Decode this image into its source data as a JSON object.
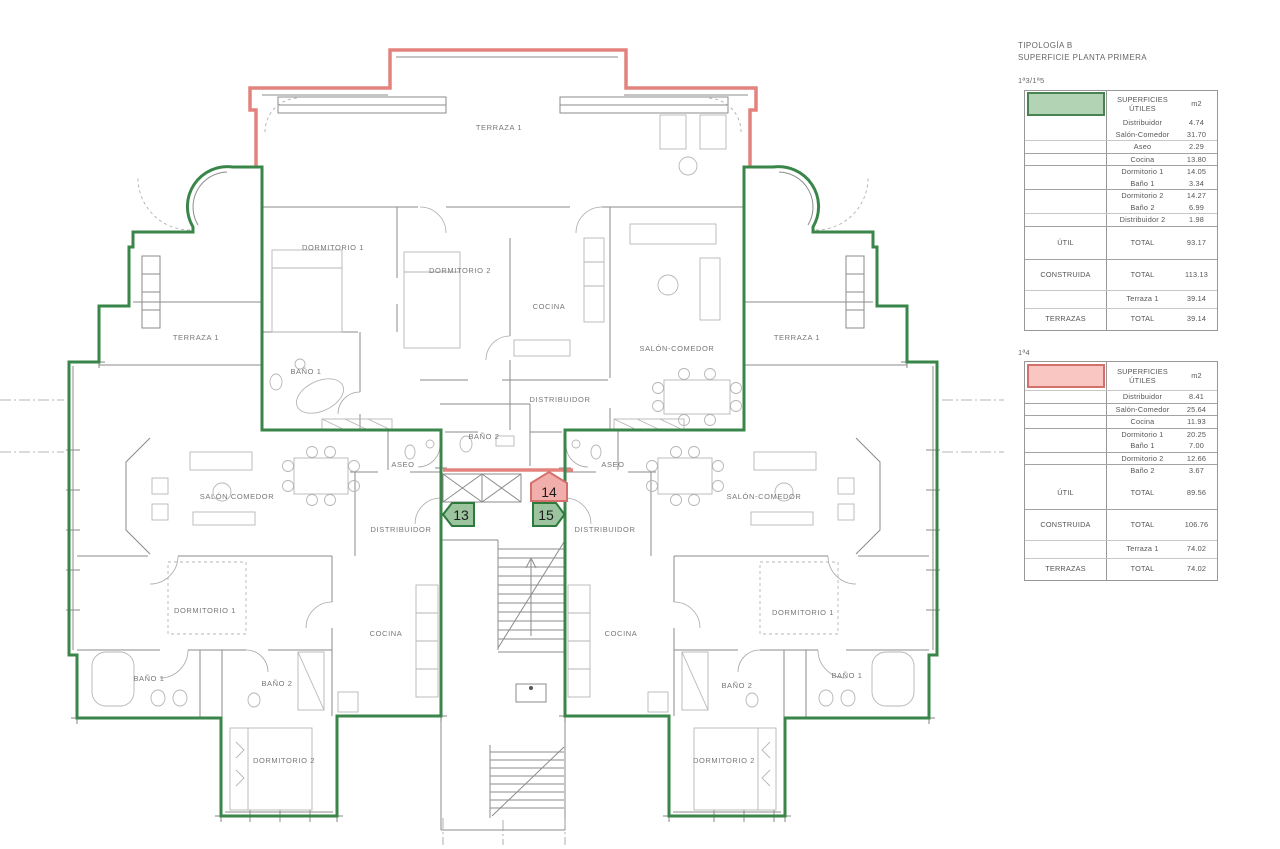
{
  "legend": {
    "title_line1": "TIPOLOGÍA B",
    "title_line2": "SUPERFICIE PLANTA PRIMERA",
    "tables": [
      {
        "unit_ref": "1ª3/1ª5",
        "swatch_color": "#b2d3b4",
        "swatch_border": "#47824f",
        "col_header_line1": "SUPERFICIES",
        "col_header_line2": "ÚTILES",
        "unit_header": "m2",
        "items": [
          {
            "name": "Distribuidor",
            "value": "4.74"
          },
          {
            "name": "Salón-Comedor",
            "value": "31.70"
          },
          {
            "name": "Aseo",
            "value": "2.29"
          },
          {
            "name": "Cocina",
            "value": "13.80"
          },
          {
            "name": "Dormitorio 1",
            "value": "14.05"
          },
          {
            "name": "Baño 1",
            "value": "3.34"
          },
          {
            "name": "Dormitorio 2",
            "value": "14.27"
          },
          {
            "name": "Baño 2",
            "value": "6.99"
          },
          {
            "name": "Distribuidor 2",
            "value": "1.98"
          }
        ],
        "totals": [
          {
            "section": "ÚTIL",
            "name": "TOTAL",
            "value": "93.17"
          },
          {
            "section": "CONSTRUIDA",
            "name": "TOTAL",
            "value": "113.13"
          },
          {
            "section": "",
            "name": "Terraza 1",
            "value": "39.14"
          },
          {
            "section": "TERRAZAS",
            "name": "TOTAL",
            "value": "39.14"
          }
        ]
      },
      {
        "unit_ref": "1ª4",
        "swatch_color": "#f9c6c2",
        "swatch_border": "#d4706b",
        "col_header_line1": "SUPERFICIES",
        "col_header_line2": "ÚTILES",
        "unit_header": "m2",
        "items": [
          {
            "name": "Distribuidor",
            "value": "8.41"
          },
          {
            "name": "Salón-Comedor",
            "value": "25.64"
          },
          {
            "name": "Cocina",
            "value": "11.93"
          },
          {
            "name": "Dormitorio 1",
            "value": "20.25"
          },
          {
            "name": "Baño 1",
            "value": "7.00"
          },
          {
            "name": "Dormitorio 2",
            "value": "12.66"
          },
          {
            "name": "Baño 2",
            "value": "3.67"
          }
        ],
        "totals": [
          {
            "section": "ÚTIL",
            "name": "TOTAL",
            "value": "89.56"
          },
          {
            "section": "CONSTRUIDA",
            "name": "TOTAL",
            "value": "106.76"
          },
          {
            "section": "",
            "name": "Terraza 1",
            "value": "74.02"
          },
          {
            "section": "TERRAZAS",
            "name": "TOTAL",
            "value": "74.02"
          }
        ]
      }
    ]
  },
  "plan": {
    "colors": {
      "units_13_15_outline": "#3a8549",
      "units_13_15_marker_fill": "#9cc49f",
      "unit_14_outline": "#e4837e",
      "unit_14_marker_fill": "#f2aeaa",
      "linework": "#8b8b8b"
    },
    "markers": [
      {
        "label": "13"
      },
      {
        "label": "14"
      },
      {
        "label": "15"
      }
    ],
    "labels": [
      "TERRAZA 1",
      "DORMITORIO 1",
      "DORMITORIO 2",
      "COCINA",
      "SALÓN-COMEDOR",
      "BAÑO 1",
      "BAÑO 2",
      "DISTRIBUIDOR",
      "ASEO",
      "ASEO",
      "TERRAZA 1",
      "TERRAZA 1",
      "SALÓN COMEDOR",
      "SALÓN-COMEDOR",
      "DISTRIBUIDOR",
      "DISTRIBUIDOR",
      "DORMITORIO 1",
      "DORMITORIO 1",
      "COCINA",
      "COCINA",
      "BAÑO 1",
      "BAÑO 2",
      "BAÑO 2",
      "BAÑO 1",
      "DORMITORIO 2",
      "DORMITORIO 2"
    ]
  }
}
